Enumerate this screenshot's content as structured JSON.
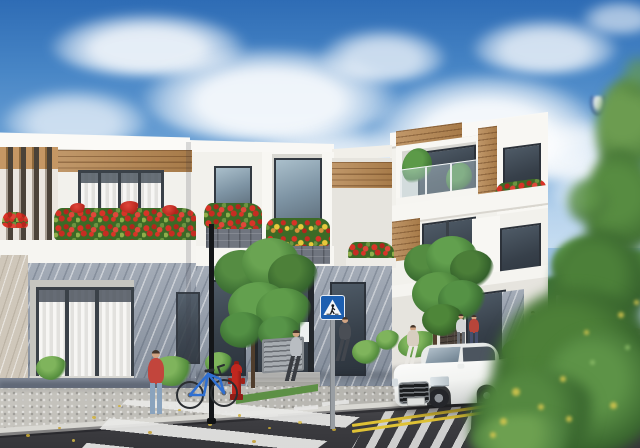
{
  "scene": {
    "description": "Sunny 3D architectural render of a modern townhouse street corner: white two- and three-storey houses with wood accents, louvered screens and balconies overflowing with red flowers; cobblestone sidewalk, zebra crosswalks, a double yellow centre line, a white sedan, pedestrians, a parked blue bicycle, a red fire hydrant and blurred green foliage framing the right side under a blue sky with cumulus clouds.",
    "sky": {
      "top_color": "#2e6cb5",
      "horizon_color": "#dff0f9",
      "cloud_color": "#ffffff",
      "balloon_color": "#4f74b2"
    }
  },
  "palette": {
    "wall_white": "#f2f1ec",
    "wood_accent": "#b5854f",
    "marble_grey": "#97a0ad",
    "marble_beige": "#cfc7ba",
    "flower_red": "#d93327",
    "flower_yellow": "#e9c83b",
    "tree_green": "#4c843c",
    "road_asphalt": "#3c3c40",
    "sidewalk_cobble": "#b4b3ae"
  },
  "buildings": [
    {
      "id": "left-house",
      "storeys": 2,
      "features": [
        "vertical louver screen",
        "horizontal wood cladding band",
        "curtained windows",
        "red flower planter",
        "grey marble ground floor",
        "beige marble pilaster"
      ]
    },
    {
      "id": "middle-house",
      "storeys": 2,
      "features": [
        "stone-clad flower boxes",
        "red and yellow flower planters",
        "tall reflective window",
        "glass entry doors",
        "white note on door",
        "entry steps"
      ]
    },
    {
      "id": "right-house",
      "storeys": 3,
      "features": [
        "glass balcony railing",
        "balcony plants",
        "vertical wood strip",
        "red flower box",
        "dark brick pier",
        "glass doors"
      ]
    }
  ],
  "street": {
    "sidewalk": "cobblestone",
    "road_color": "#3c3c40",
    "crosswalk_color": "#e9e9e7",
    "center_line_color": "#dfc235",
    "fallen_leaves_color": "#cfae35",
    "grass_verge_color": "#5d9045"
  },
  "vehicle": {
    "type": "sedan",
    "color_name": "white",
    "body_color": "#f2f3f1",
    "glass_color": "#55606c"
  },
  "bicycle": {
    "frame_color": "#2f6fd1"
  },
  "signs": {
    "pedestrian_crossing": {
      "bg_color": "#1d5fb0",
      "symbol": "white triangle with walking figure"
    },
    "sign_back_color": "#d6d8d5"
  },
  "props": {
    "fire_hydrant_color": "#c0271f",
    "lamp_post_color": "#141619",
    "utility_box_color": "#a7acb1"
  },
  "people": [
    {
      "role": "woman standing checking phone",
      "top_color": "#c2453c",
      "bottom_color": "#8aa3bd"
    },
    {
      "role": "man walking",
      "top_color": "#b9bdc2",
      "bottom_color": "#3a3d42"
    },
    {
      "role": "man in suit walking",
      "top_color": "#4a4e55",
      "bottom_color": "#42464d"
    },
    {
      "role": "woman walking",
      "top_color": "#d8cec0",
      "bottom_color": "#e9e7e2"
    },
    {
      "role": "pedestrian",
      "top_color": "#d3d5d6",
      "bottom_color": "#6b7076"
    },
    {
      "role": "pedestrian",
      "top_color": "#b8453a",
      "bottom_color": "#47506e"
    },
    {
      "role": "distant pedestrian",
      "top_color": "#5a7ba3",
      "bottom_color": "#444851"
    },
    {
      "role": "distant pedestrian",
      "top_color": "#3f434a",
      "bottom_color": "#34373c"
    },
    {
      "role": "distant pedestrian",
      "top_color": "#55585e",
      "bottom_color": "#3c3f45"
    },
    {
      "role": "scooter rider",
      "top_color": "#d3bd35",
      "bottom_color": "#8c7d20"
    }
  ],
  "vegetation": {
    "street_trees": 2,
    "street_tree_green": "#4c843c",
    "hedge_green": "#2e5a2e",
    "foreground_blur_green": "#35602b",
    "bokeh_flower_yellow": "#d9c84e"
  }
}
